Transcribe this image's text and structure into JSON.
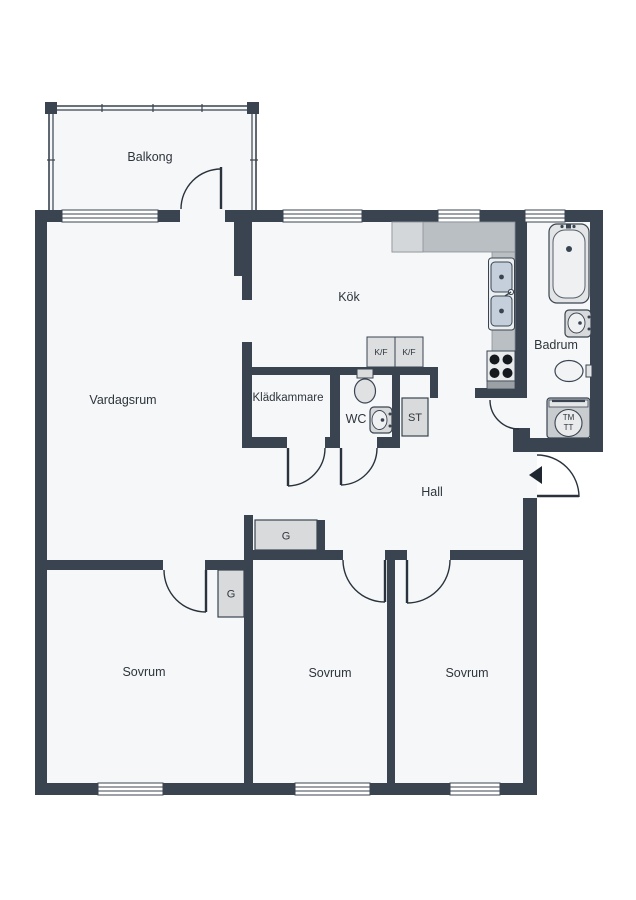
{
  "plan": {
    "type": "apartment-floor-plan",
    "rooms": {
      "balkong": "Balkong",
      "vardagsrum": "Vardagsrum",
      "kok": "Kök",
      "kladkammare": "Klädkammare",
      "wc": "WC",
      "badrum": "Badrum",
      "hall": "Hall",
      "sovrum_1": "Sovrum",
      "sovrum_2": "Sovrum",
      "sovrum_3": "Sovrum"
    },
    "closets": {
      "st": "ST",
      "g_hall": "G",
      "g_sovrum": "G",
      "kf_1": "K/F",
      "kf_2": "K/F"
    },
    "appliances": {
      "washer_line1": "TM",
      "washer_line2": "TT"
    },
    "colors": {
      "wall": "#3a4450",
      "floor": "#f6f7f8",
      "fixture_gray": "#d8dadb",
      "counter_gray": "#b9bfc3",
      "sink_bowl": "#c5cfdb",
      "arc_line": "#2a333d"
    }
  }
}
